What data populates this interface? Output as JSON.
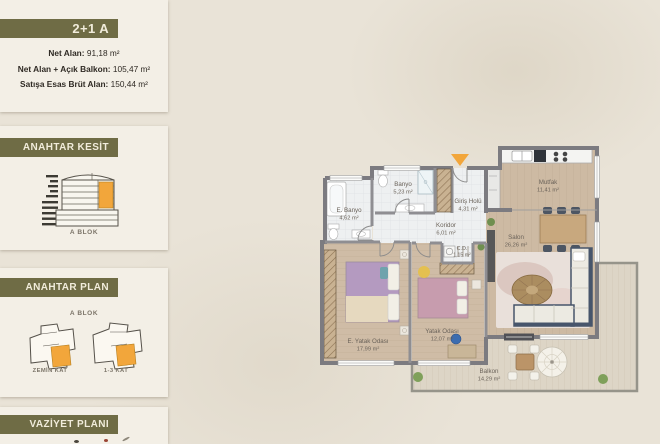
{
  "colors": {
    "bg": "#e9e3d7",
    "card": "#f3efe6",
    "olive": "#6f6c45",
    "olivetext": "#f1ecdb",
    "ink": "#2f2a24",
    "orange": "#f2a63b",
    "wall": "#7c7b80",
    "label": "#6b635a"
  },
  "sidebar": {
    "unit_card": {
      "title": "2+1 A",
      "stats": [
        {
          "label": "Net Alan:",
          "value": "91,18 m²"
        },
        {
          "label": "Net Alan + Açık Balkon:",
          "value": "105,47 m²"
        },
        {
          "label": "Satışa Esas Brüt Alan:",
          "value": "150,44 m²"
        }
      ]
    },
    "kesit_card": {
      "title": "ANAHTAR KESİT",
      "caption": "A BLOK"
    },
    "plan_card": {
      "title": "ANAHTAR PLAN",
      "block_label": "A BLOK",
      "plans": [
        {
          "caption": "ZEMİN KAT"
        },
        {
          "caption": "1-3 KAT"
        }
      ]
    },
    "vaziyet_card": {
      "title": "VAZİYET PLANI"
    }
  },
  "floor_plan": {
    "rooms": [
      {
        "name": "Mutfak",
        "area": "11,41 m²"
      },
      {
        "name": "Salon",
        "area": "26,26 m²"
      },
      {
        "name": "Giriş Holü",
        "area": "4,31 m²"
      },
      {
        "name": "Banyo",
        "area": "5,23 m²"
      },
      {
        "name": "E. Banyo",
        "area": "4,62 m²"
      },
      {
        "name": "Koridor",
        "area": "6,01 m²"
      },
      {
        "name": "C.D.",
        "area": "1,15 m²"
      },
      {
        "name": "Yatak Odası",
        "area": "12,07 m²"
      },
      {
        "name": "E. Yatak Odası",
        "area": "17,99 m²"
      },
      {
        "name": "Balkon",
        "area": "14,29 m²"
      }
    ]
  }
}
